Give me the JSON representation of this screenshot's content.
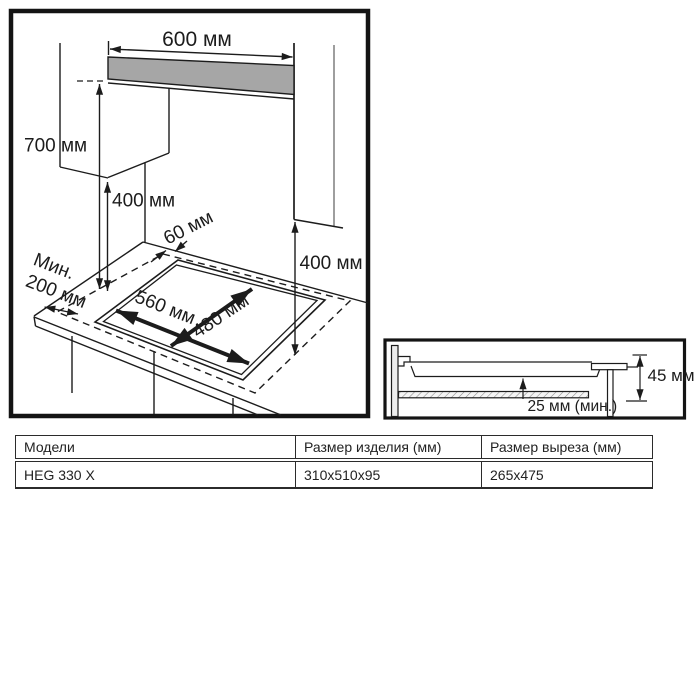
{
  "colors": {
    "line": "#1c1c1c",
    "hood_fill": "#a6a6a6",
    "wall_fill": "#ededed",
    "background": "#ffffff"
  },
  "main_diagram": {
    "dims": {
      "hood_width": "600 мм",
      "hood_clearance": "700 мм",
      "cabinet_clearance_left": "400 мм",
      "back_gap": "60 мм",
      "side_min_line1": "Мин.",
      "side_min_line2": "200 мм",
      "cutout_width": "560 мм",
      "cutout_depth": "480 мм",
      "cabinet_clearance_right": "400 мм"
    }
  },
  "detail_diagram": {
    "dims": {
      "build_in_height": "45 мм",
      "min_bottom_gap": "25 мм (мин.)"
    }
  },
  "table": {
    "headers": [
      "Модели",
      "Размер изделия (мм)",
      "Размер выреза (мм)"
    ],
    "rows": [
      [
        "HEG 330 X",
        "310x510x95",
        "265x475"
      ]
    ]
  }
}
